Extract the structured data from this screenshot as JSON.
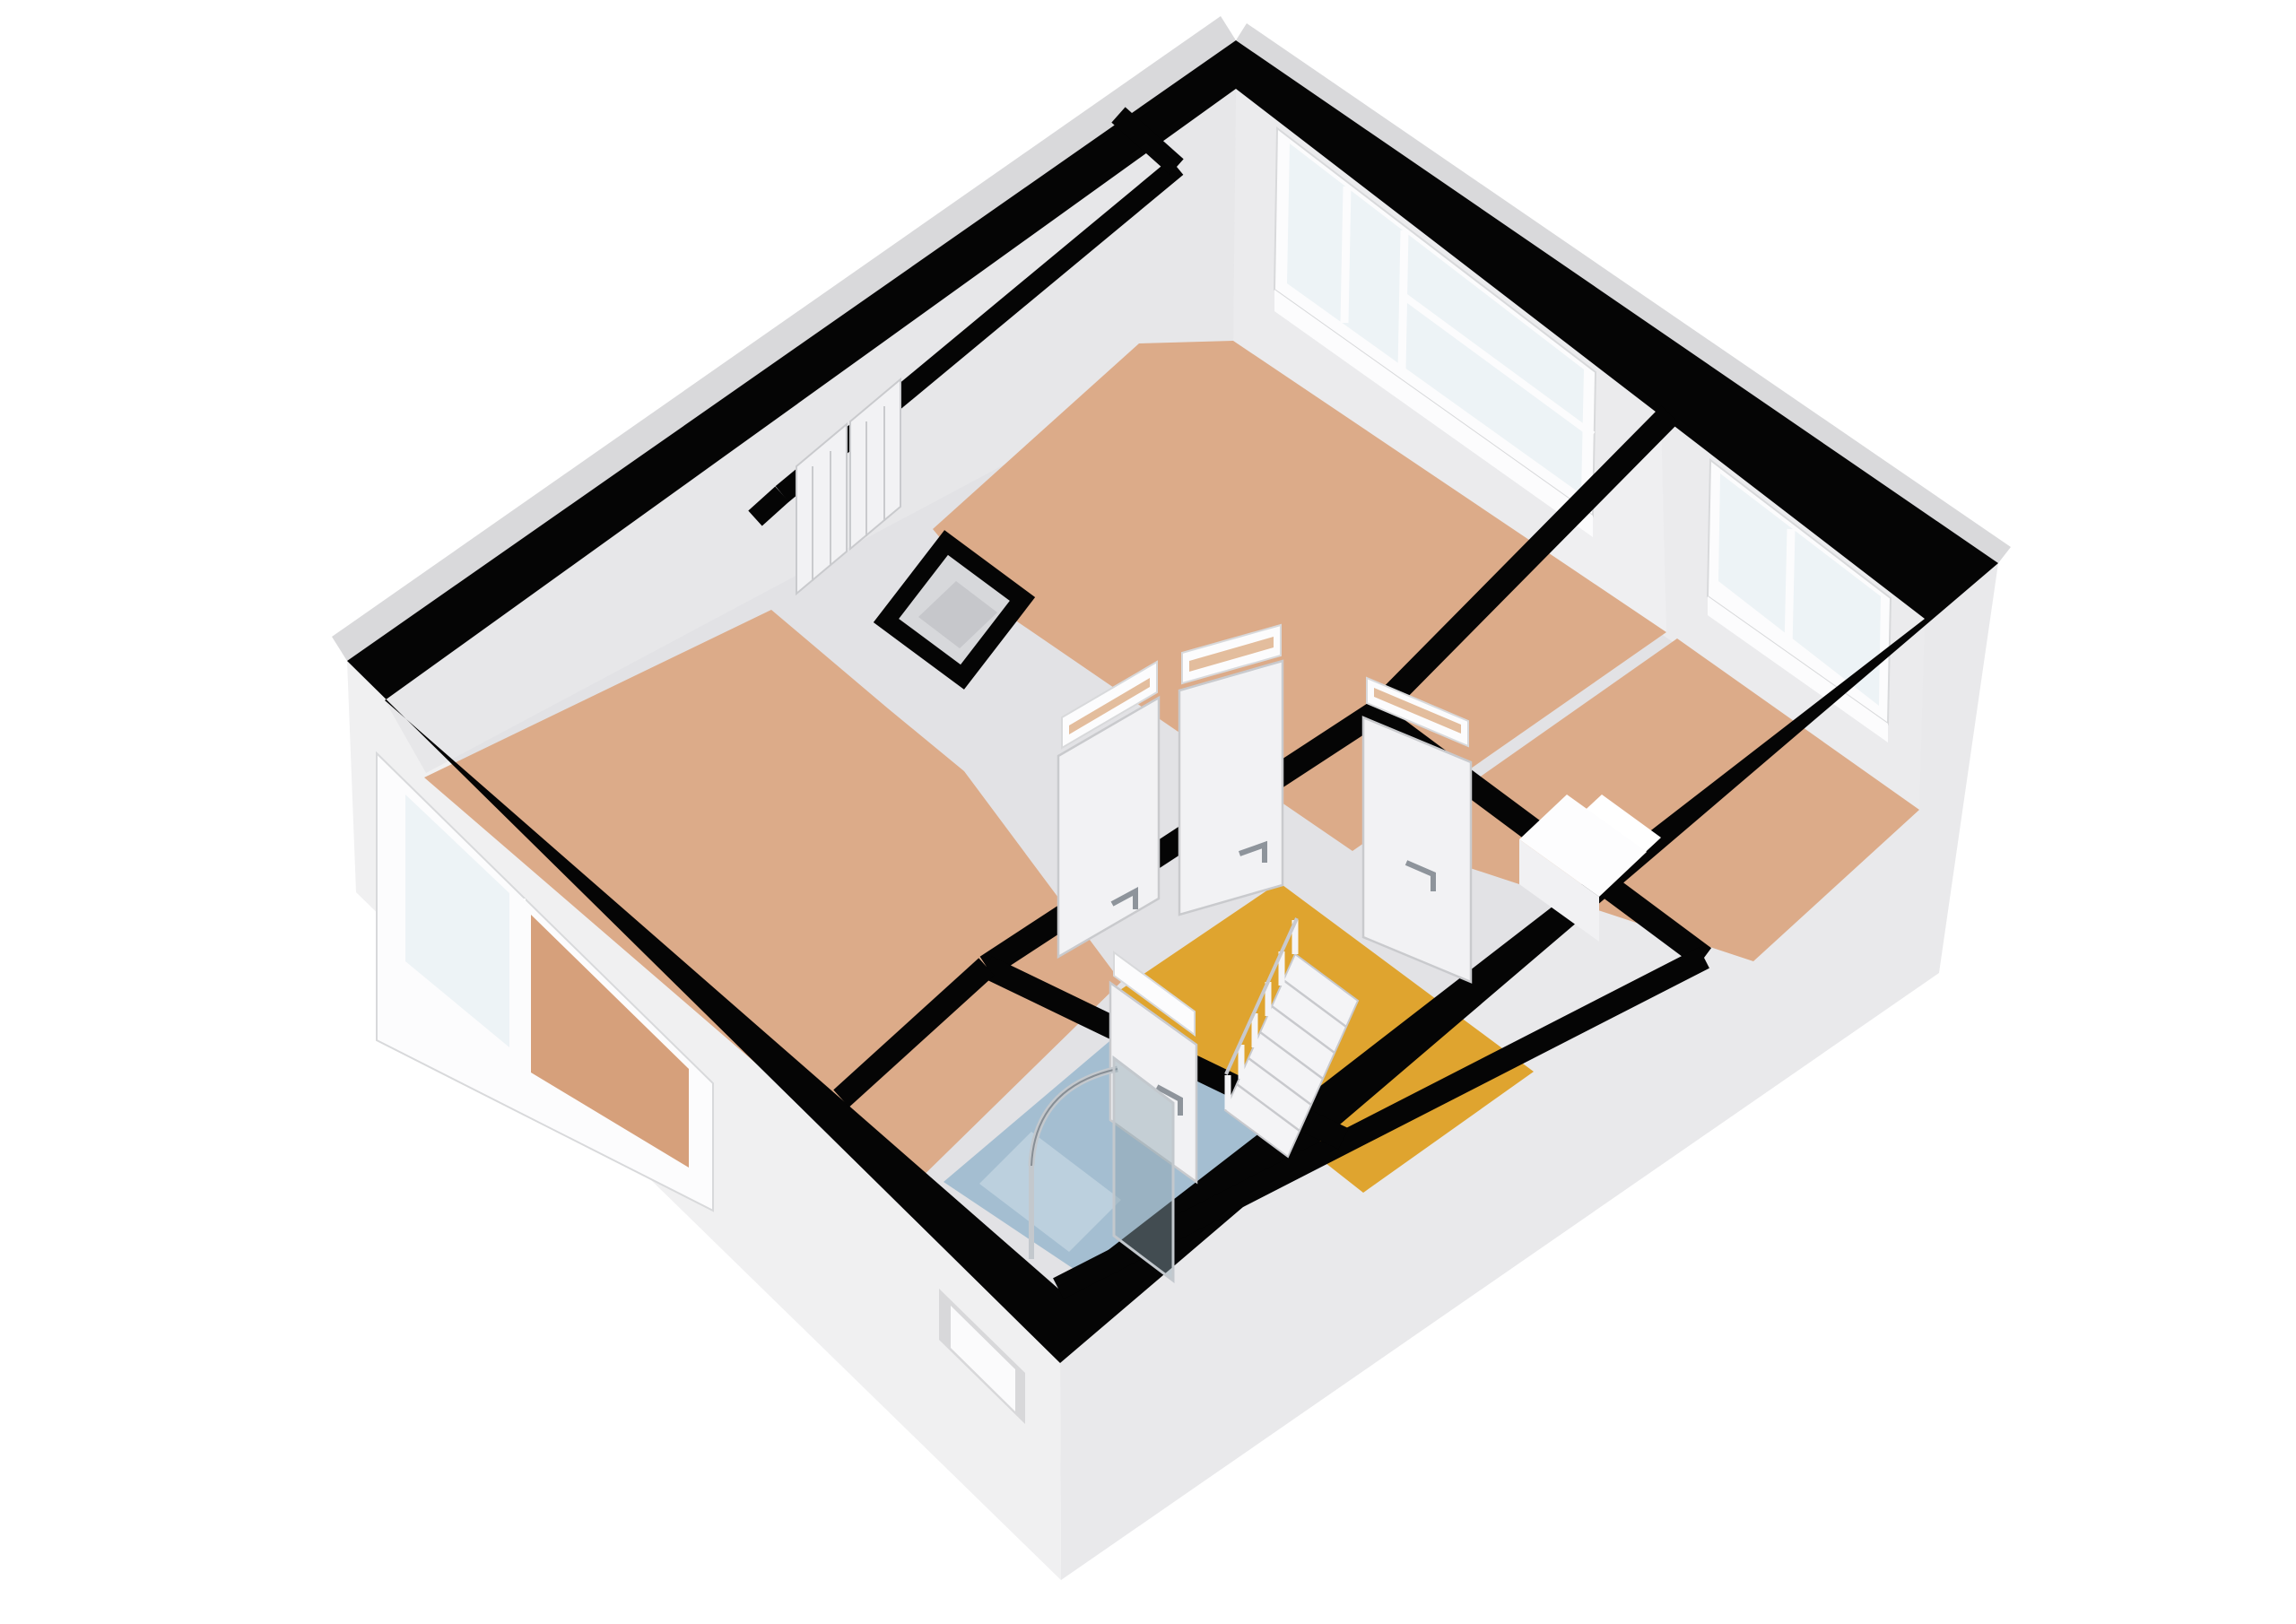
{
  "scene": {
    "kind": "3d-floorplan-render",
    "view": "axonometric-top",
    "background": "#ffffff"
  },
  "colors": {
    "background": "#ffffff",
    "wall_top_black": "#050505",
    "exterior_sw_face": "#f0f0f1",
    "exterior_se_face": "#e9e9eb",
    "exterior_rim": "#d9d9db",
    "recess_shadow": "#d8d8da",
    "recess_face": "#fbfbfc",
    "wall_base": "#e2e2e5",
    "wall_ne_face": "#ebebed",
    "wall_nw_face": "#e7e7e9",
    "wall_partition_face": "#efeff1",
    "floor_wood": "#dcab89",
    "floor_wood_deep": "#d6a07b",
    "floor_hall": "#dfa42f",
    "floor_bath": "#a4bed1",
    "floor_shower": "#bcd0de",
    "floor_shaft": "#c6c7cb",
    "shaft_wall": "#d7d8db",
    "glass": "#edf3f6",
    "glass_frame": "#fcfcfd",
    "frame_stroke": "#d8d9db",
    "door": "#f2f2f4",
    "door_stroke": "#c9cacd",
    "handle": "#8e949b",
    "transom_slot": "#e3bd9d",
    "stairs": "#f4f4f6",
    "stair_stroke": "#c8c9cd",
    "rail_chrome": "#c3c8cd",
    "rail_dark": "#878e95",
    "shower_glass": "#8fa3b0",
    "counter": "#fdfdfe",
    "counter_front": "#f1f1f3",
    "opening_white": "#ffffff"
  },
  "rooms": [
    {
      "id": "living-room",
      "floor_material": "wood",
      "floor_color_ref": "floor_wood"
    },
    {
      "id": "bedroom-right",
      "floor_material": "wood",
      "floor_color_ref": "floor_wood"
    },
    {
      "id": "bedroom-left",
      "floor_material": "wood",
      "floor_color_ref": "floor_wood"
    },
    {
      "id": "hallway",
      "floor_material": "vinyl",
      "floor_color_ref": "floor_hall"
    },
    {
      "id": "bathroom",
      "floor_material": "tile",
      "floor_color_ref": "floor_bath"
    },
    {
      "id": "closet",
      "floor_material": "none",
      "floor_color_ref": "wall_base"
    },
    {
      "id": "shaft",
      "floor_material": "screed",
      "floor_color_ref": "floor_shaft"
    }
  ],
  "fixtures": {
    "staircase": {
      "located_in": "hallway",
      "steps": 6,
      "balusters": 6
    },
    "shower": {
      "located_in": "bathroom",
      "glass_panel": true,
      "curved_rail": true
    },
    "counter_block": {
      "located_in": "bedroom-right"
    },
    "windows": [
      {
        "id": "window-ne-living",
        "wall": "north-east",
        "panes": 3
      },
      {
        "id": "window-ne-bedroom",
        "wall": "north-east",
        "panes": 2
      },
      {
        "id": "window-sw-bedroom",
        "wall": "south-west",
        "panes": 2
      }
    ],
    "doors": [
      {
        "id": "door-living",
        "from": "hallway",
        "to": "living-room",
        "transom": true
      },
      {
        "id": "door-bedroom-right",
        "from": "hallway",
        "to": "bedroom-right",
        "transom": true
      },
      {
        "id": "door-bedroom-left",
        "from": "hallway",
        "to": "bedroom-left",
        "transom": true
      },
      {
        "id": "door-bathroom",
        "from": "hallway",
        "to": "bathroom",
        "transom": true
      },
      {
        "id": "closet-doors",
        "from": "closet",
        "to": "closet",
        "leaves": 2
      }
    ],
    "exterior_door_recess": {
      "wall": "south-west"
    }
  }
}
